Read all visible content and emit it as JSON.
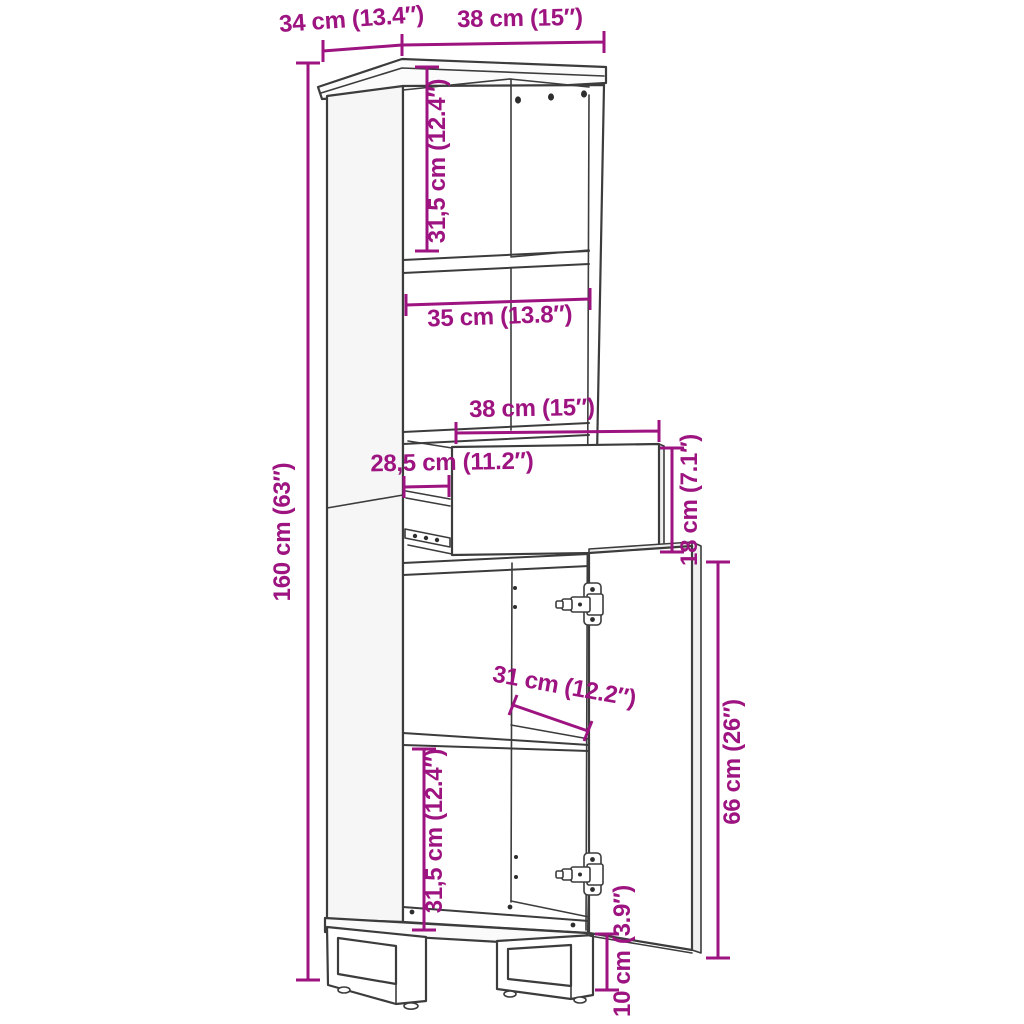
{
  "diagram": {
    "kind": "furniture-dimension-drawing",
    "subject": "tall cabinet with open shelves, pull-out drawer, open door and sled legs",
    "background_color": "#ffffff",
    "line_color": "#3c3c3c",
    "dimension_color": "#9d1380",
    "labels": {
      "top_depth": "34 cm (13.4″)",
      "top_width": "38 cm (15″)",
      "total_height": "160 cm (63″)",
      "upper_section_height": "31,5 cm (12.4″)",
      "middle_shelf_width": "35 cm (13.8″)",
      "drawer_width": "38 cm (15″)",
      "drawer_depth": "28,5 cm (11.2″)",
      "drawer_height": "18 cm (7.1″)",
      "lower_shelf_width": "31 cm (12.2″)",
      "door_height": "66 cm (26″)",
      "lower_section_height": "31,5 cm (12.4″)",
      "leg_height": "10 cm (3.9″)"
    }
  }
}
